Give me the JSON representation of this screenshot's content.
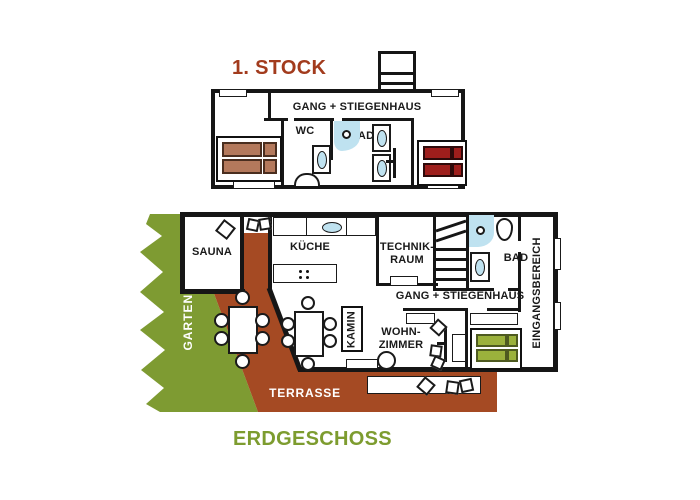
{
  "palette": {
    "wall": "#161616",
    "terrace": "#A54A23",
    "garden": "#7E9B32",
    "water": "#BFE2F0",
    "title_first": "#A23B1D",
    "title_ground": "#7D9C2F",
    "bed_brown": "#B4795C",
    "bed_brown_border": "#4A2E1F",
    "bed_red": "#9E1E1C",
    "bed_red_border": "#2E0A0A",
    "bed_green": "#9BB13C",
    "bed_green_border": "#4E5A20"
  },
  "first_floor": {
    "title": "1. STOCK",
    "corridor": "GANG + STIEGENHAUS",
    "wc": "WC",
    "bad": "BAD"
  },
  "ground_floor": {
    "title": "ERDGESCHOSS",
    "sauna": "SAUNA",
    "kitchen": "KÜCHE",
    "technik_line1": "TECHNIK-",
    "technik_line2": "RAUM",
    "bad": "BAD",
    "corridor": "GANG + STIEGENHAUS",
    "living_line1": "WOHN-",
    "living_line2": "ZIMMER",
    "kamin": "KAMIN",
    "garden": "GARTEN",
    "terrace": "TERRASSE",
    "entrance": "EINGANGSBEREICH"
  }
}
